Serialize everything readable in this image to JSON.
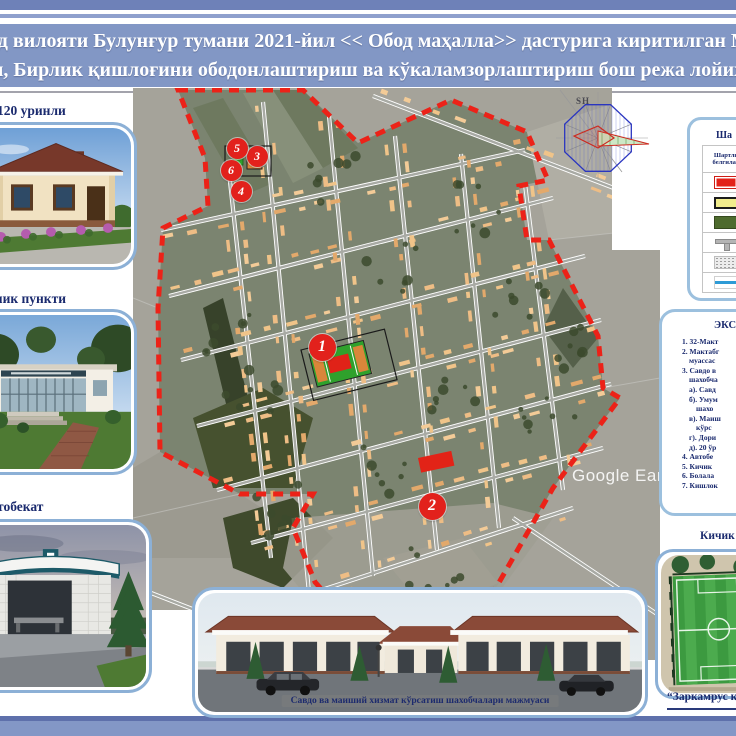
{
  "title": {
    "line1": "нд вилояти Булунғур тумани 2021-йил << Обод маҳалла>> дастурига киритилган М",
    "line2": "и, Бирлик қишлоғини ободонлаштириш ва кўкаламзорлаштириш бош режа лойиҳ"
  },
  "left_panels": [
    {
      "label": "120 уринли",
      "image": "cottage-render"
    },
    {
      "label": "лик пункти",
      "image": "clinic-render"
    },
    {
      "label": "тобекат",
      "image": "bus-stop-render"
    }
  ],
  "legend": {
    "title": "Ша",
    "col1": "Шартли",
    "col2": "белгилар",
    "symbols": [
      "red-rect",
      "yellow-rect",
      "green-rect",
      "road-section",
      "gravel",
      "blue-line"
    ]
  },
  "explication": {
    "title": "ЭКС",
    "items": [
      {
        "text": "1. 32-Макт",
        "indent": 0
      },
      {
        "text": "2. Мактабг",
        "indent": 0
      },
      {
        "text": "муассас",
        "indent": 1
      },
      {
        "text": "3. Савдо в",
        "indent": 0
      },
      {
        "text": "шахобча",
        "indent": 1
      },
      {
        "text": "а). Савд",
        "indent": 1
      },
      {
        "text": "б). Умум",
        "indent": 1
      },
      {
        "text": "шахо",
        "indent": 2
      },
      {
        "text": "в). Маиш",
        "indent": 1
      },
      {
        "text": "кўрс",
        "indent": 2
      },
      {
        "text": "г). Дори",
        "indent": 1
      },
      {
        "text": "д). 20 ўр",
        "indent": 1
      },
      {
        "text": "4.  Автобе",
        "indent": 0
      },
      {
        "text": "5.  Кичик",
        "indent": 0
      },
      {
        "text": "6.  Болала",
        "indent": 0
      },
      {
        "text": "7.  Кишлок",
        "indent": 0
      }
    ]
  },
  "right_bottom": {
    "label": "Кичик",
    "image": "mini-stadium-render",
    "credit": "“Заркамрус  қ"
  },
  "bottom_panel": {
    "caption": "Савдо ва маиший хизмат кўрсатиш шахобчалари мажмуаси"
  },
  "map": {
    "watermark": "Google Eart",
    "compass_label": "SH",
    "markers": [
      {
        "label": "1",
        "x": 189,
        "y": 259,
        "d": 27
      },
      {
        "label": "2",
        "x": 299,
        "y": 418,
        "d": 27
      },
      {
        "label": "3",
        "x": 124,
        "y": 68,
        "d": 21
      },
      {
        "label": "4",
        "x": 108,
        "y": 103,
        "d": 21
      },
      {
        "label": "5",
        "x": 104,
        "y": 60,
        "d": 21
      },
      {
        "label": "6",
        "x": 98,
        "y": 82,
        "d": 21
      }
    ]
  },
  "colors": {
    "marker_red": "#e2211c",
    "boundary_red": "#ec2218",
    "panel_border_blue": "#8cb0d6",
    "navy_text": "#1a2a6e",
    "title_band_blue": "#8297c5",
    "building_tan": "#eebd85"
  }
}
